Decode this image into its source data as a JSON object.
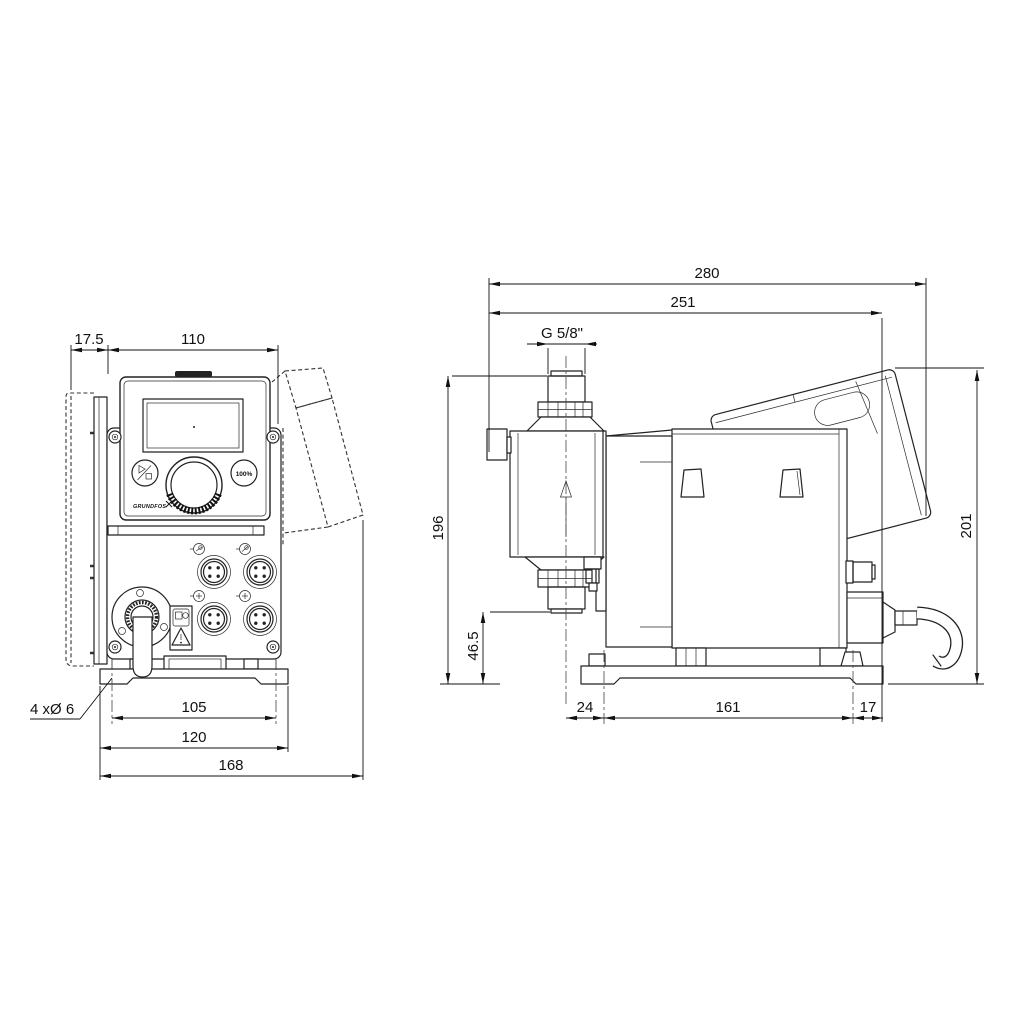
{
  "drawing": {
    "background": "#ffffff",
    "line_color": "#222222",
    "front_view": {
      "name": "front-view",
      "panel": {
        "brand_logo": "GRUNDFOS",
        "max_button_label": "100%",
        "start_stop_icon": "play-stop-icon"
      },
      "dims": {
        "wall_plate_offset": "17.5",
        "housing_width": "110",
        "mounting_hole_spacing": "105",
        "base_plate_width": "120",
        "overall_depth": "168",
        "mounting_holes_note": "4 xØ 6"
      }
    },
    "side_view": {
      "name": "side-view",
      "dims": {
        "overall_depth": "280",
        "depth_to_rear_face": "251",
        "connection_thread": "G 5/8\"",
        "height_valve_top": "196",
        "height_valve_bottom": "46.5",
        "overall_height": "201",
        "axis_to_front_hole": "24",
        "foot_hole_spacing": "161",
        "rear_hole_to_edge": "17"
      }
    },
    "icons": {
      "connector": "m12-connector",
      "gland": "cable-gland",
      "warning": "warning-triangle"
    }
  }
}
